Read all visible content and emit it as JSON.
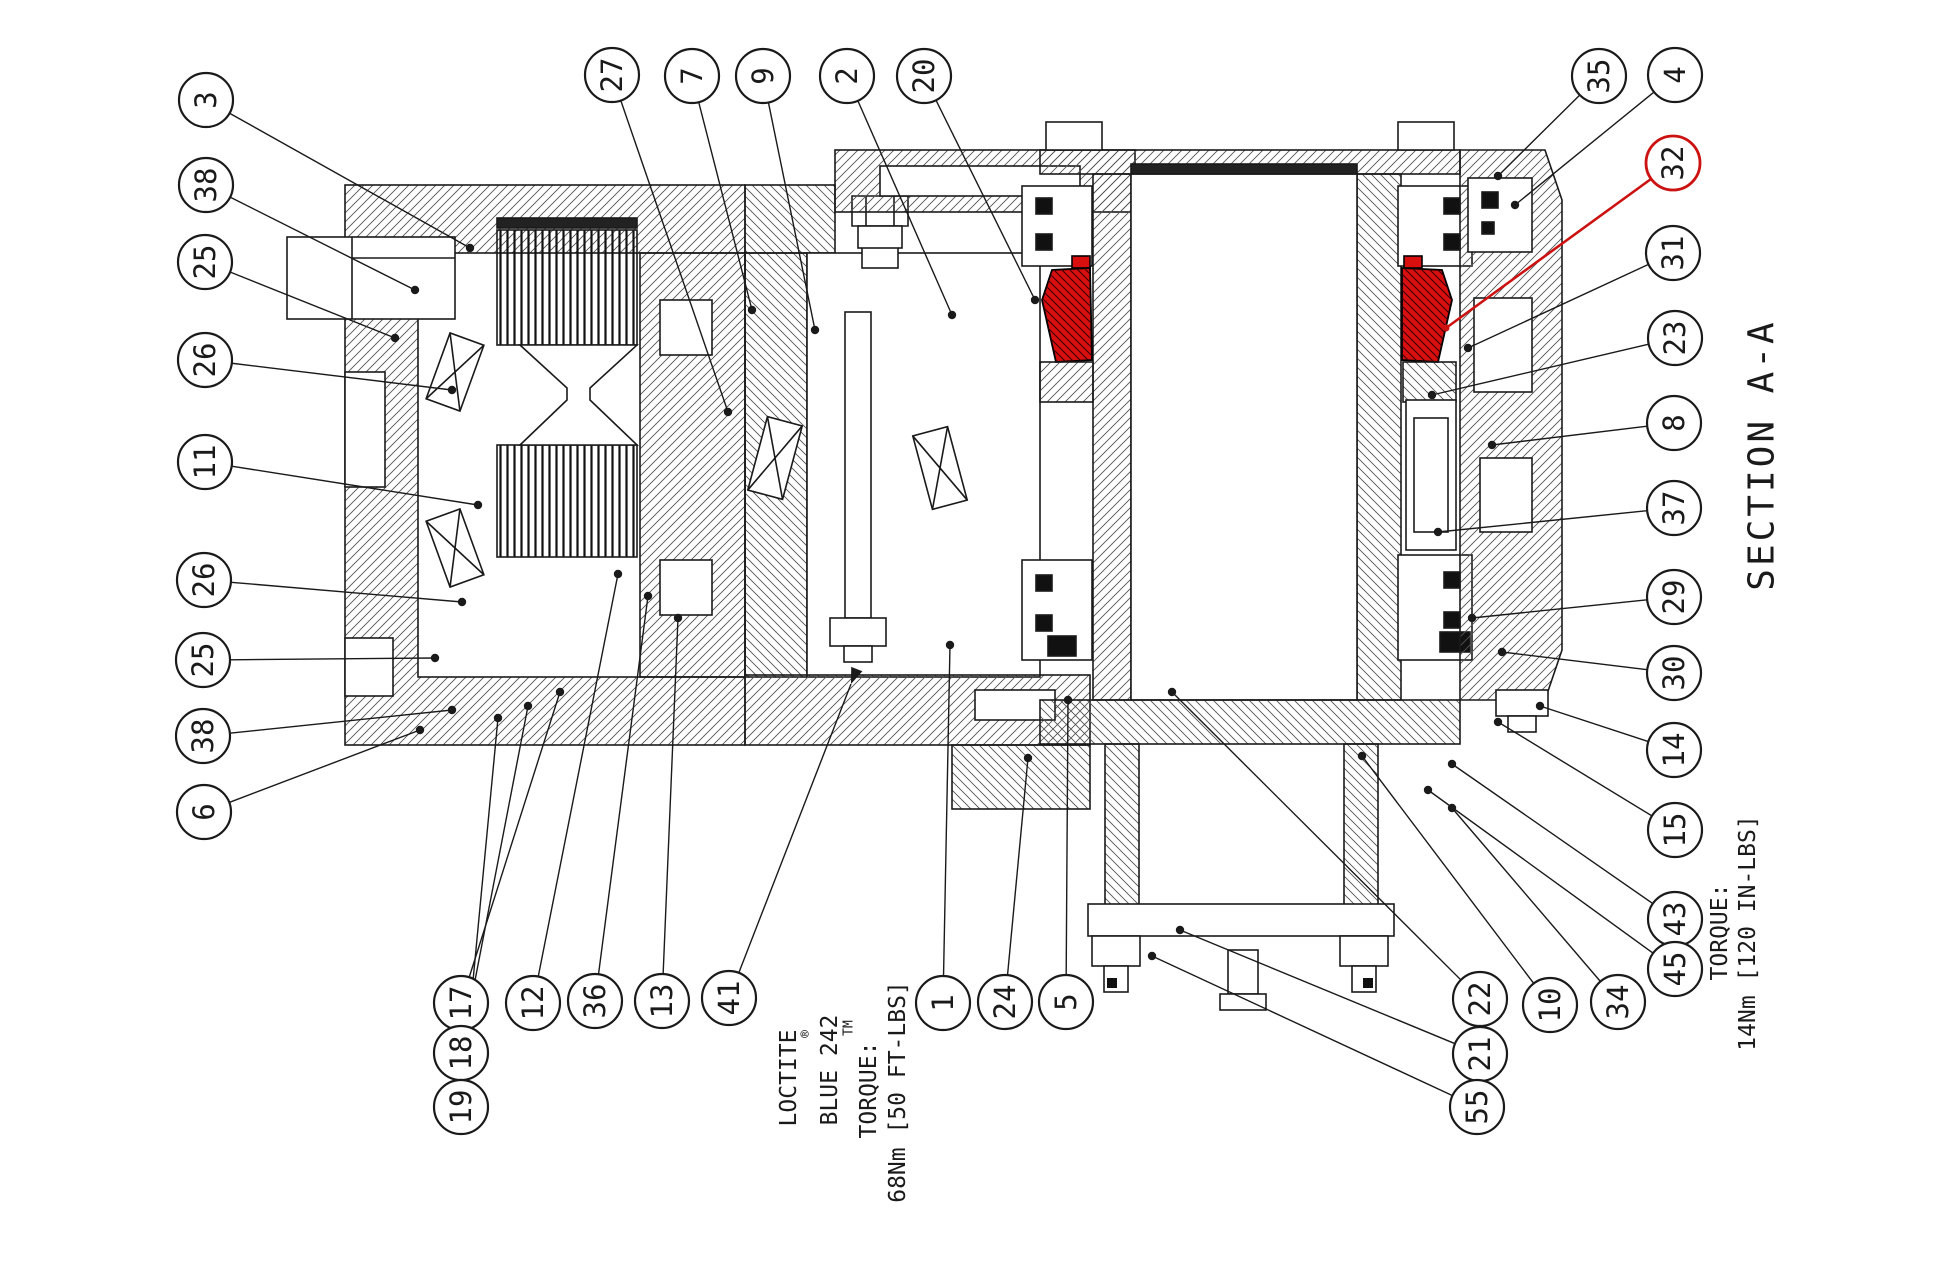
{
  "drawing": {
    "section_label": "SECTION A-A",
    "notes": {
      "left": {
        "line1": "LOCTITE",
        "reg": "®",
        "line2": "BLUE 242",
        "tm": "TM",
        "line3": "TORQUE:",
        "line4": "68Nm [50 FT-LBS]"
      },
      "right": {
        "line1": "TORQUE:",
        "line2": "14Nm [120 IN-LBS]"
      }
    },
    "colors": {
      "line": "#1a1a1a",
      "highlight": "#cc1111",
      "highlight_fill": "#d90f0f"
    },
    "selected_part": "32",
    "balloons": [
      {
        "label": "3",
        "x": 206,
        "y": 100,
        "tx": 470,
        "ty": 248
      },
      {
        "label": "38",
        "x": 206,
        "y": 185,
        "tx": 415,
        "ty": 290
      },
      {
        "label": "25",
        "x": 205,
        "y": 262,
        "tx": 395,
        "ty": 338
      },
      {
        "label": "26",
        "x": 205,
        "y": 360,
        "tx": 452,
        "ty": 390
      },
      {
        "label": "11",
        "x": 205,
        "y": 462,
        "tx": 478,
        "ty": 505
      },
      {
        "label": "26",
        "x": 204,
        "y": 580,
        "tx": 462,
        "ty": 602
      },
      {
        "label": "25",
        "x": 203,
        "y": 660,
        "tx": 435,
        "ty": 658
      },
      {
        "label": "38",
        "x": 203,
        "y": 736,
        "tx": 452,
        "ty": 710
      },
      {
        "label": "6",
        "x": 204,
        "y": 812,
        "tx": 420,
        "ty": 730
      },
      {
        "label": "27",
        "x": 612,
        "y": 75,
        "tx": 728,
        "ty": 412
      },
      {
        "label": "7",
        "x": 692,
        "y": 76,
        "tx": 752,
        "ty": 310
      },
      {
        "label": "9",
        "x": 763,
        "y": 76,
        "tx": 815,
        "ty": 330
      },
      {
        "label": "2",
        "x": 847,
        "y": 76,
        "tx": 952,
        "ty": 315
      },
      {
        "label": "20",
        "x": 924,
        "y": 76,
        "tx": 1035,
        "ty": 300
      },
      {
        "label": "35",
        "x": 1599,
        "y": 76,
        "tx": 1498,
        "ty": 176
      },
      {
        "label": "4",
        "x": 1675,
        "y": 75,
        "tx": 1515,
        "ty": 205
      },
      {
        "label": "32",
        "x": 1673,
        "y": 163,
        "tx": 1446,
        "ty": 328,
        "red": true
      },
      {
        "label": "31",
        "x": 1673,
        "y": 253,
        "tx": 1468,
        "ty": 348
      },
      {
        "label": "23",
        "x": 1675,
        "y": 338,
        "tx": 1432,
        "ty": 395
      },
      {
        "label": "8",
        "x": 1674,
        "y": 423,
        "tx": 1492,
        "ty": 445
      },
      {
        "label": "37",
        "x": 1674,
        "y": 508,
        "tx": 1438,
        "ty": 532
      },
      {
        "label": "29",
        "x": 1674,
        "y": 597,
        "tx": 1472,
        "ty": 618
      },
      {
        "label": "30",
        "x": 1674,
        "y": 673,
        "tx": 1502,
        "ty": 652
      },
      {
        "label": "14",
        "x": 1674,
        "y": 750,
        "tx": 1540,
        "ty": 706
      },
      {
        "label": "15",
        "x": 1675,
        "y": 830,
        "tx": 1498,
        "ty": 722
      },
      {
        "label": "43",
        "x": 1675,
        "y": 919,
        "tx": 1452,
        "ty": 764
      },
      {
        "label": "45",
        "x": 1675,
        "y": 969,
        "tx": 1428,
        "ty": 790
      },
      {
        "label": "34",
        "x": 1618,
        "y": 1002,
        "tx": 1452,
        "ty": 808
      },
      {
        "label": "10",
        "x": 1550,
        "y": 1005,
        "tx": 1362,
        "ty": 756
      },
      {
        "label": "22",
        "x": 1480,
        "y": 999,
        "tx": 1172,
        "ty": 692
      },
      {
        "label": "21",
        "x": 1480,
        "y": 1054,
        "tx": 1180,
        "ty": 930
      },
      {
        "label": "55",
        "x": 1477,
        "y": 1107,
        "tx": 1152,
        "ty": 956
      },
      {
        "label": "17",
        "x": 461,
        "y": 1003,
        "tx": 560,
        "ty": 692
      },
      {
        "label": "18",
        "x": 461,
        "y": 1053,
        "tx": 528,
        "ty": 706
      },
      {
        "label": "19",
        "x": 461,
        "y": 1107,
        "tx": 498,
        "ty": 718
      },
      {
        "label": "12",
        "x": 533,
        "y": 1003,
        "tx": 618,
        "ty": 574
      },
      {
        "label": "36",
        "x": 595,
        "y": 1001,
        "tx": 648,
        "ty": 596
      },
      {
        "label": "13",
        "x": 662,
        "y": 1001,
        "tx": 678,
        "ty": 618
      },
      {
        "label": "41",
        "x": 729,
        "y": 998,
        "tx": 851,
        "ty": 684,
        "arrow": true
      },
      {
        "label": "1",
        "x": 943,
        "y": 1003,
        "tx": 950,
        "ty": 645
      },
      {
        "label": "24",
        "x": 1005,
        "y": 1002,
        "tx": 1028,
        "ty": 758
      },
      {
        "label": "5",
        "x": 1066,
        "y": 1002,
        "tx": 1068,
        "ty": 700
      }
    ]
  }
}
